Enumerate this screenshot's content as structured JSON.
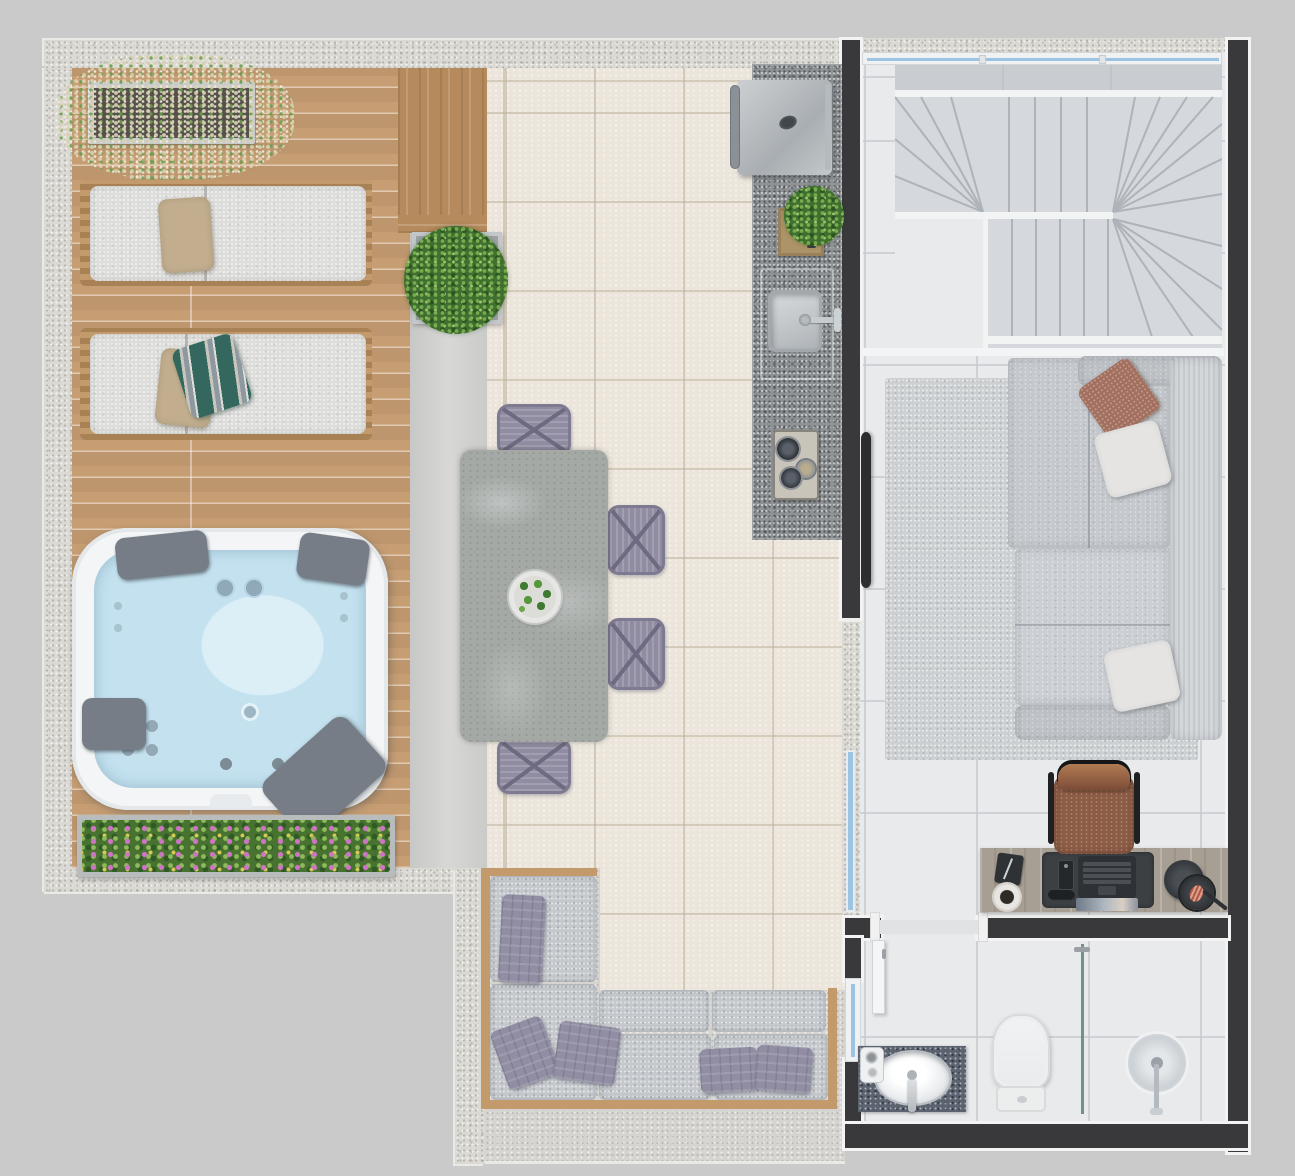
{
  "meta": {
    "image_kind": "architectural-floor-plan-rendering",
    "view": "top-down",
    "canvas": {
      "width_px": 1295,
      "height_px": 1176
    },
    "text_visible": "none"
  },
  "colors": {
    "bg": "#cacaca",
    "stucco": "#dbd9d4",
    "stucco-floor": "#d6d4d0",
    "deck": "#c79e73",
    "wood-accent": "#b58a5c",
    "wood-frame": "#c29a6b",
    "concrete": "#d2d3d1",
    "tile-cream": "#ebe5db",
    "tile-indoor": "#e9eaec",
    "granite": "#8f9396",
    "granite-dark": "#5c6370",
    "wall-dark": "#39393b",
    "trim-white": "#f2f3f2",
    "stair": "#d5d8dc",
    "rug": "#cdd0d2",
    "sofa": "#c5c9cd",
    "cushion": "#dddddb",
    "pillow-purple": "#918ea4",
    "pillow-beige": "#c2ae8e",
    "pillow-teal": "#34685e",
    "pillow-brown": "#a3705f",
    "water": "#c3e1ef",
    "water-light": "#dceff7",
    "jacuzzi-rim": "#f3f5f6",
    "headrest": "#767d87",
    "glass-blue": "#9cc3e2",
    "green": "#3f7030",
    "table-stone": "#a4a9a6",
    "chair-lav": "#908ca1",
    "steel": "#c2c7ca",
    "desk-wood": "#a89f94",
    "leather": "#8d5c45",
    "shower-glass": "#5d837b",
    "toilet-white": "#f1f2f3"
  },
  "areas": {
    "terrace": {
      "floors": [
        "wood-deck",
        "accent-wood-panel",
        "concrete-strip",
        "cream-tile-patio",
        "stucco-lounge-nook"
      ],
      "items": [
        "grass-planter-box",
        "sun-lounger",
        "sun-lounger",
        "jacuzzi-spa",
        "flower-planter-box",
        "boxwood-planter",
        "dining-table-stone",
        "dining-chair-x4",
        "table-centerpiece-plant",
        "outdoor-kitchen-counter",
        "bbq-grill",
        "serving-tray-with-plant",
        "outdoor-sink",
        "cooktop-burners",
        "l-shaped-outdoor-sofa",
        "lavender-throw-pillows"
      ]
    },
    "indoor": {
      "rooms": [
        "stair-hall",
        "living-room",
        "bathroom"
      ],
      "stair_hall_items": [
        "u-shaped-winder-staircase",
        "long-window"
      ],
      "living_room_items": [
        "area-rug",
        "l-shaped-sofa",
        "chaise-section",
        "throw-pillows-brown-white",
        "wall-mounted-tv",
        "desk",
        "leather-desk-chair",
        "laptop",
        "desk-mat",
        "notepad",
        "coffee-cup",
        "smartphone",
        "glasses",
        "desk-lamp",
        "sliding-glass-door"
      ],
      "bathroom_items": [
        "entry-door",
        "vanity-counter",
        "oval-sink",
        "faucet",
        "soap-set",
        "toilet",
        "glass-shower-partition",
        "floor-shower-drain",
        "side-window"
      ]
    }
  }
}
